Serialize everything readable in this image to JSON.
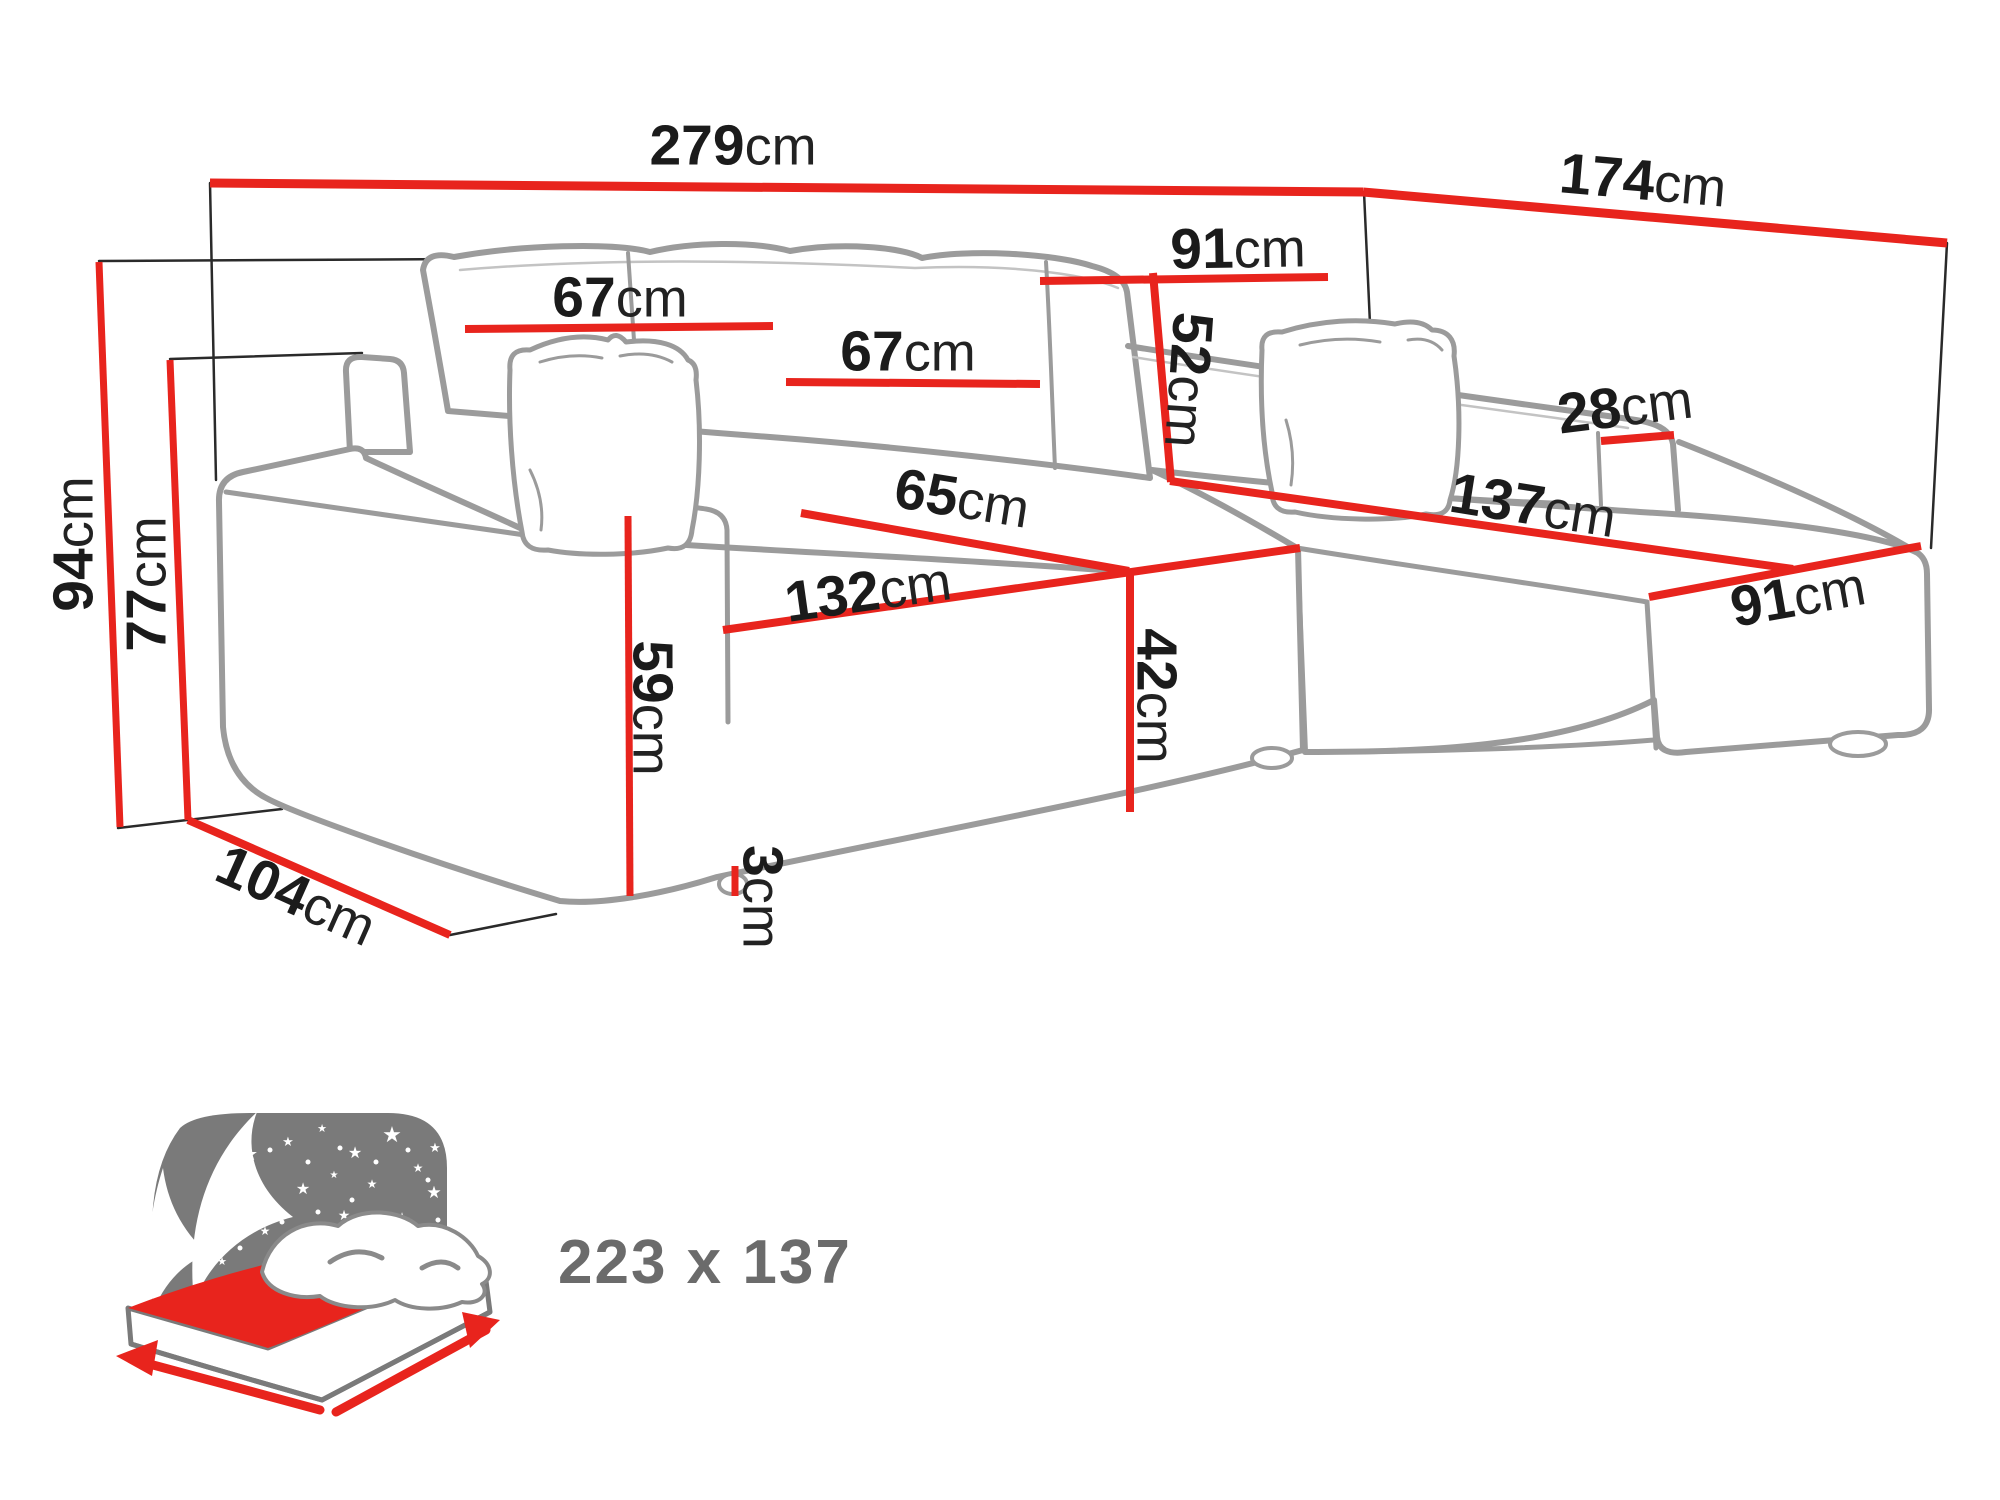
{
  "diagram_type": "corner-sofa-bed-dimension-diagram",
  "unit": "cm",
  "colors": {
    "dimension_line": "#e8241d",
    "sofa_outline": "#9b9b9b",
    "extension_line": "#2a2a2a",
    "label_text": "#1b1b1b",
    "icon_gray": "#7a7a7a",
    "icon_text": "#6b6b6b"
  },
  "sofa_dimensions": [
    {
      "id": "total-width",
      "value": "279",
      "unit": "cm",
      "line": {
        "x1": 210,
        "y1": 183,
        "x2": 1363,
        "y2": 192,
        "w": 9
      },
      "label": {
        "x": 733,
        "y": 146,
        "rot": 0
      }
    },
    {
      "id": "total-depth-right",
      "value": "174",
      "unit": "cm",
      "line": {
        "x1": 1363,
        "y1": 192,
        "x2": 1947,
        "y2": 243,
        "w": 9
      },
      "label": {
        "x": 1643,
        "y": 181,
        "rot": 5
      }
    },
    {
      "id": "total-height",
      "value": "94",
      "unit": "cm",
      "line": {
        "x1": 99,
        "y1": 262,
        "x2": 120,
        "y2": 827,
        "w": 7
      },
      "label": {
        "x": 74,
        "y": 544,
        "rot": -90
      }
    },
    {
      "id": "armrest-height",
      "value": "77",
      "unit": "cm",
      "line": {
        "x1": 170,
        "y1": 360,
        "x2": 188,
        "y2": 820,
        "w": 7
      },
      "label": {
        "x": 147,
        "y": 584,
        "rot": -90
      }
    },
    {
      "id": "base-depth",
      "value": "104",
      "unit": "cm",
      "line": {
        "x1": 188,
        "y1": 820,
        "x2": 450,
        "y2": 935,
        "w": 8
      },
      "label": {
        "x": 296,
        "y": 896,
        "rot": 24
      }
    },
    {
      "id": "back-cushion-left-width",
      "value": "67",
      "unit": "cm",
      "line": {
        "x1": 465,
        "y1": 329,
        "x2": 773,
        "y2": 326,
        "w": 8
      },
      "label": {
        "x": 620,
        "y": 298,
        "rot": 0
      }
    },
    {
      "id": "back-cushion-mid-width",
      "value": "67",
      "unit": "cm",
      "line": {
        "x1": 786,
        "y1": 382,
        "x2": 1040,
        "y2": 384,
        "w": 8
      },
      "label": {
        "x": 908,
        "y": 352,
        "rot": 0
      }
    },
    {
      "id": "back-section-width",
      "value": "91",
      "unit": "cm",
      "line": {
        "x1": 1040,
        "y1": 281,
        "x2": 1328,
        "y2": 277,
        "w": 8
      },
      "label": {
        "x": 1238,
        "y": 249,
        "rot": -1
      }
    },
    {
      "id": "backrest-height",
      "value": "52",
      "unit": "cm",
      "line": {
        "x1": 1153,
        "y1": 273,
        "x2": 1171,
        "y2": 482,
        "w": 8
      },
      "label": {
        "x": 1188,
        "y": 380,
        "rot": 94
      }
    },
    {
      "id": "seat-depth",
      "value": "65",
      "unit": "cm",
      "line": {
        "x1": 801,
        "y1": 513,
        "x2": 1129,
        "y2": 571,
        "w": 8
      },
      "label": {
        "x": 962,
        "y": 499,
        "rot": 9
      }
    },
    {
      "id": "seat-width",
      "value": "132",
      "unit": "cm",
      "line": {
        "x1": 723,
        "y1": 630,
        "x2": 1300,
        "y2": 548,
        "w": 8
      },
      "label": {
        "x": 868,
        "y": 592,
        "rot": -8
      }
    },
    {
      "id": "seat-height",
      "value": "42",
      "unit": "cm",
      "line": {
        "x1": 1130,
        "y1": 572,
        "x2": 1130,
        "y2": 812,
        "w": 8
      },
      "label": {
        "x": 1156,
        "y": 696,
        "rot": 90
      }
    },
    {
      "id": "front-height",
      "value": "59",
      "unit": "cm",
      "line": {
        "x1": 628,
        "y1": 516,
        "x2": 630,
        "y2": 896,
        "w": 7
      },
      "label": {
        "x": 652,
        "y": 708,
        "rot": 90
      }
    },
    {
      "id": "leg-height",
      "value": "3",
      "unit": "cm",
      "line": {
        "x1": 735,
        "y1": 866,
        "x2": 735,
        "y2": 896,
        "w": 7
      },
      "label": {
        "x": 762,
        "y": 897,
        "rot": 90
      }
    },
    {
      "id": "right-armrest-width",
      "value": "28",
      "unit": "cm",
      "line": {
        "x1": 1601,
        "y1": 441,
        "x2": 1674,
        "y2": 435,
        "w": 8
      },
      "label": {
        "x": 1625,
        "y": 407,
        "rot": -7
      }
    },
    {
      "id": "chaise-length",
      "value": "137",
      "unit": "cm",
      "line": {
        "x1": 1170,
        "y1": 481,
        "x2": 1793,
        "y2": 569,
        "w": 8
      },
      "label": {
        "x": 1533,
        "y": 506,
        "rot": 9
      }
    },
    {
      "id": "chaise-width",
      "value": "91",
      "unit": "cm",
      "line": {
        "x1": 1649,
        "y1": 597,
        "x2": 1921,
        "y2": 546,
        "w": 8
      },
      "label": {
        "x": 1798,
        "y": 597,
        "rot": -10
      }
    }
  ],
  "bed_icon": {
    "meaning": "sleeping-surface-size",
    "label": "223 x 137"
  }
}
